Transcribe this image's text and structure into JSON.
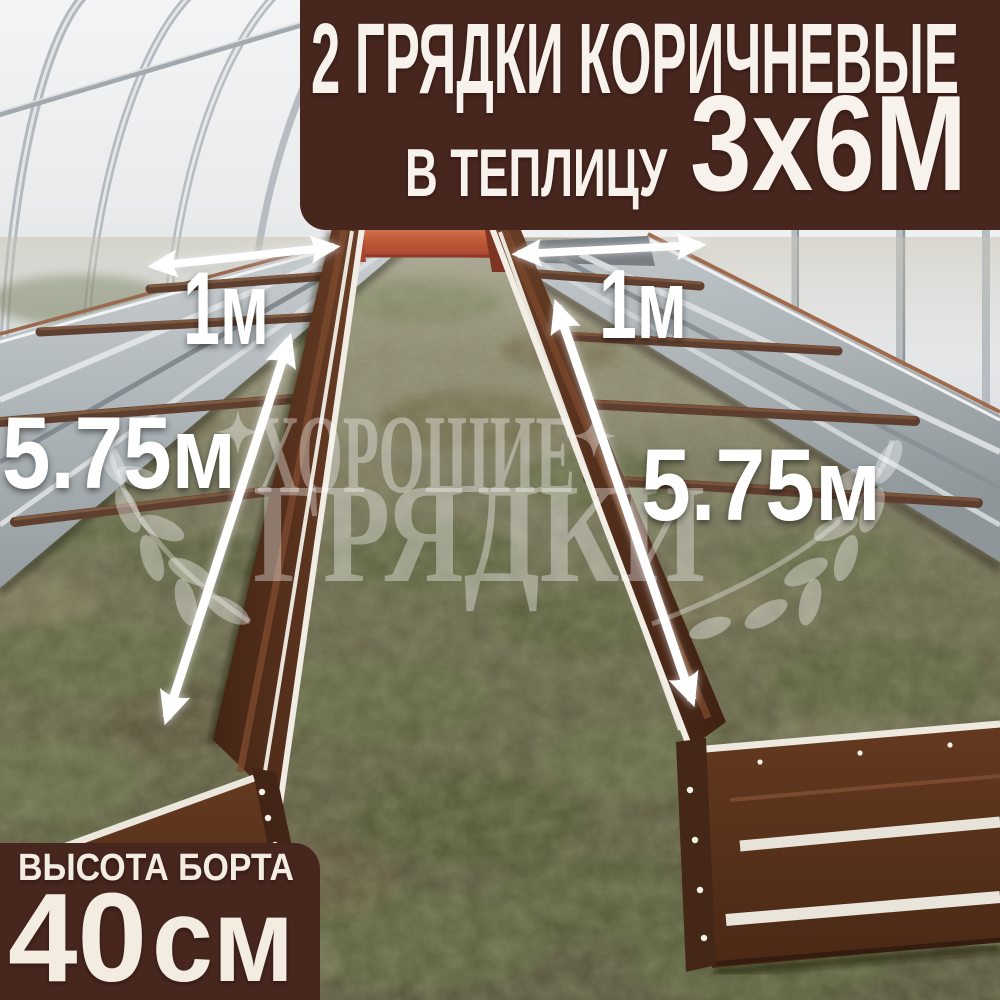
{
  "banner": {
    "line1": "2 ГРЯДКИ КОРИЧНЕВЫЕ",
    "line2_prefix": "В ТЕПЛИЦУ",
    "line2_size": "3х6М"
  },
  "badge": {
    "title": "ВЫСОТА БОРТА",
    "value": "40",
    "unit": "см"
  },
  "measurements": {
    "left_bed_width": "1м",
    "right_bed_width": "1м",
    "left_bed_length": "5.75м",
    "right_bed_length": "5.75м"
  },
  "watermark": {
    "line1": "ХОРОШИЕ",
    "line2": "ГРЯДКИ"
  },
  "colors": {
    "panel_brown": "#47261e",
    "text_cream": "#f7f3ec",
    "bed_brown": "#5a3420",
    "bed_rail_white": "#f1ede4",
    "accent_red": "#c05a3a",
    "galvanized_silver": "#b4bbbf",
    "label_white": "#ffffff"
  }
}
